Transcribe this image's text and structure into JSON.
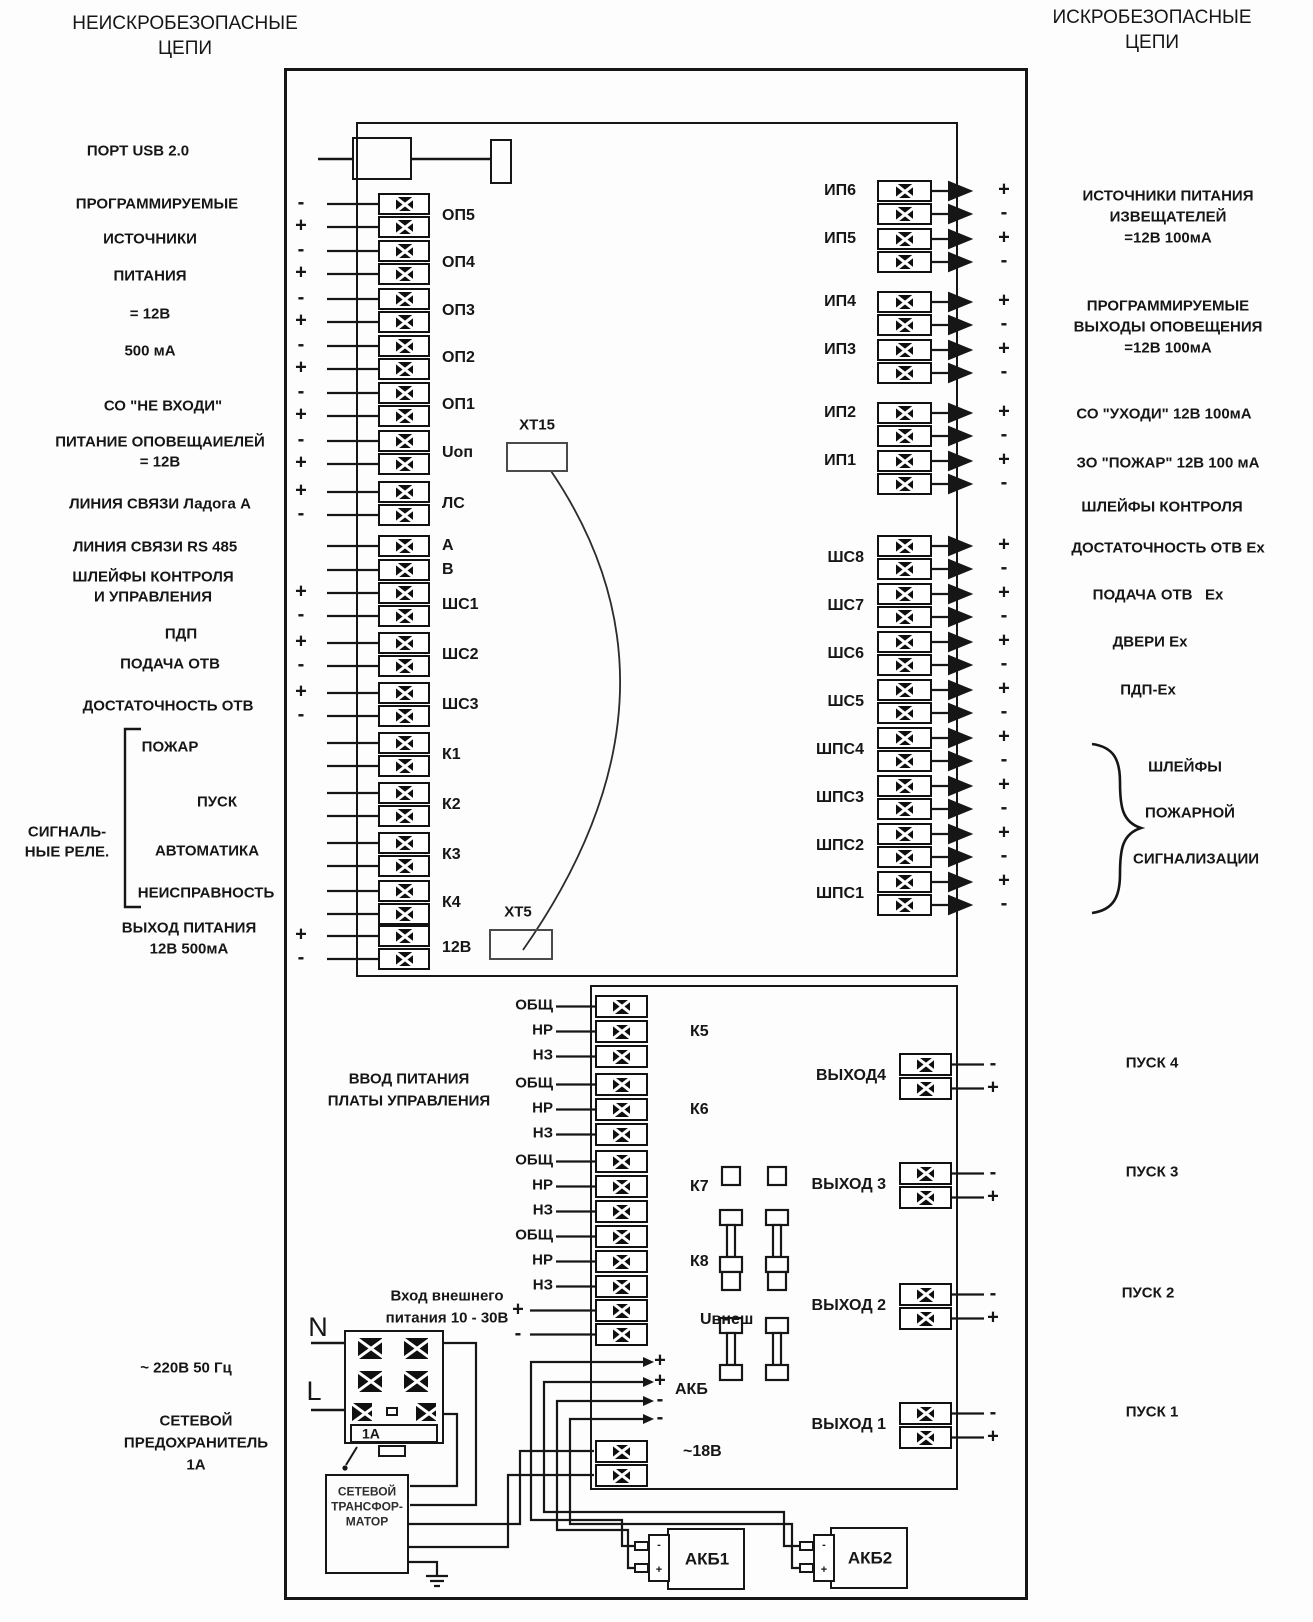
{
  "titles": {
    "left_line1": "НЕИСКРОБЕЗОПАСНЫЕ",
    "left_line2": "ЦЕПИ",
    "right_line1": "ИСКРОБЕЗОПАСНЫЕ",
    "right_line2": "ЦЕПИ"
  },
  "left_annotations": [
    {
      "text": "ПОРТ USB 2.0"
    },
    {
      "text": "ПРОГРАММИРУЕМЫЕ"
    },
    {
      "text": "ИСТОЧНИКИ"
    },
    {
      "text": "ПИТАНИЯ"
    },
    {
      "text": "= 12В"
    },
    {
      "text": "500 мА"
    },
    {
      "text": "СО \"НЕ ВХОДИ\""
    },
    {
      "text": "ПИТАНИЕ ОПОВЕЩАИЕЛЕЙ"
    },
    {
      "text": "= 12В"
    },
    {
      "text": "ЛИНИЯ СВЯЗИ Ладога А"
    },
    {
      "text": "ЛИНИЯ СВЯЗИ RS 485"
    },
    {
      "text": "ШЛЕЙФЫ КОНТРОЛЯ"
    },
    {
      "text": "И УПРАВЛЕНИЯ"
    },
    {
      "text": "ПДП"
    },
    {
      "text": "ПОДАЧА ОТВ"
    },
    {
      "text": "ДОСТАТОЧНОСТЬ ОТВ"
    },
    {
      "text": "ПОЖАР"
    },
    {
      "text": "ПУСК"
    },
    {
      "text": "АВТОМАТИКА"
    },
    {
      "text": "НЕИСПРАВНОСТЬ"
    },
    {
      "text": "СИГНАЛЬ-"
    },
    {
      "text": "НЫЕ РЕЛЕ."
    },
    {
      "text": "ВЫХОД ПИТАНИЯ"
    },
    {
      "text": "12В 500мА"
    },
    {
      "text": "~ 220В 50 Гц"
    },
    {
      "text": "СЕТЕВОЙ"
    },
    {
      "text": "ПРЕДОХРАНИТЕЛЬ"
    },
    {
      "text": "1А"
    }
  ],
  "right_annotations": [
    {
      "text": "ИСТОЧНИКИ ПИТАНИЯ"
    },
    {
      "text": "ИЗВЕЩАТЕЛЕЙ"
    },
    {
      "text": "=12В 100мА"
    },
    {
      "text": "ПРОГРАММИРУЕМЫЕ"
    },
    {
      "text": "ВЫХОДЫ ОПОВЕЩЕНИЯ"
    },
    {
      "text": "=12В 100мА"
    },
    {
      "text": "СО \"УХОДИ\" 12В 100мА"
    },
    {
      "text": "ЗО \"ПОЖАР\" 12В 100 мА"
    },
    {
      "text": "ШЛЕЙФЫ КОНТРОЛЯ"
    },
    {
      "text": "ДОСТАТОЧНОСТЬ ОТВ Ex"
    },
    {
      "text": "ПОДАЧА ОТВ   Ex"
    },
    {
      "text": "ДВЕРИ Ex"
    },
    {
      "text": "ПДП-Ex"
    },
    {
      "text": "ШЛЕЙФЫ"
    },
    {
      "text": "ПОЖАРНОЙ"
    },
    {
      "text": "СИГНАЛИЗАЦИИ"
    },
    {
      "text": "ПУСК 4"
    },
    {
      "text": "ПУСК 3"
    },
    {
      "text": "ПУСК 2"
    },
    {
      "text": "ПУСК 1"
    }
  ],
  "board1": {
    "left_groups": [
      {
        "id": "op5",
        "label": "ОП5",
        "signs": [
          "-",
          "+"
        ]
      },
      {
        "id": "op4",
        "label": "ОП4",
        "signs": [
          "-",
          "+"
        ]
      },
      {
        "id": "op3",
        "label": "ОП3",
        "signs": [
          "-",
          "+"
        ]
      },
      {
        "id": "op2",
        "label": "ОП2",
        "signs": [
          "-",
          "+"
        ]
      },
      {
        "id": "op1",
        "label": "ОП1",
        "signs": [
          "-",
          "+"
        ]
      },
      {
        "id": "uop",
        "label": "Uоп",
        "signs": [
          "-",
          "+"
        ]
      },
      {
        "id": "ls",
        "label": "ЛС",
        "signs": [
          "+",
          "-"
        ]
      },
      {
        "id": "a",
        "label": "А",
        "signs": [
          ""
        ]
      },
      {
        "id": "b",
        "label": "В",
        "signs": [
          ""
        ]
      },
      {
        "id": "shs1",
        "label": "ШС1",
        "signs": [
          "+",
          "-"
        ]
      },
      {
        "id": "shs2",
        "label": "ШС2",
        "signs": [
          "+",
          "-"
        ]
      },
      {
        "id": "shs3",
        "label": "ШС3",
        "signs": [
          "+",
          "-"
        ]
      },
      {
        "id": "k1",
        "label": "К1",
        "signs": [
          "",
          ""
        ]
      },
      {
        "id": "k2",
        "label": "К2",
        "signs": [
          "",
          ""
        ]
      },
      {
        "id": "k3",
        "label": "К3",
        "signs": [
          "",
          ""
        ]
      },
      {
        "id": "k4",
        "label": "К4",
        "signs": [
          "",
          ""
        ]
      },
      {
        "id": "12v",
        "label": "12В",
        "signs": [
          "+",
          "-"
        ]
      }
    ],
    "ip_groups": [
      {
        "id": "ip6",
        "label": "ИП6",
        "signs": [
          "+",
          "-"
        ]
      },
      {
        "id": "ip5",
        "label": "ИП5",
        "signs": [
          "+",
          "-"
        ]
      },
      {
        "id": "ip4",
        "label": "ИП4",
        "signs": [
          "+",
          "-"
        ]
      },
      {
        "id": "ip3",
        "label": "ИП3",
        "signs": [
          "+",
          "-"
        ]
      },
      {
        "id": "ip2",
        "label": "ИП2",
        "signs": [
          "+",
          "-"
        ]
      },
      {
        "id": "ip1",
        "label": "ИП1",
        "signs": [
          "+",
          "-"
        ]
      }
    ],
    "shs_groups": [
      {
        "id": "shs8",
        "label": "ШС8",
        "signs": [
          "+",
          "-"
        ]
      },
      {
        "id": "shs7",
        "label": "ШС7",
        "signs": [
          "+",
          "-"
        ]
      },
      {
        "id": "shs6",
        "label": "ШС6",
        "signs": [
          "+",
          "-"
        ]
      },
      {
        "id": "shs5",
        "label": "ШС5",
        "signs": [
          "+",
          "-"
        ]
      },
      {
        "id": "shps4",
        "label": "ШПС4",
        "signs": [
          "+",
          "-"
        ]
      },
      {
        "id": "shps3",
        "label": "ШПС3",
        "signs": [
          "+",
          "-"
        ]
      },
      {
        "id": "shps2",
        "label": "ШПС2",
        "signs": [
          "+",
          "-"
        ]
      },
      {
        "id": "shps1",
        "label": "ШПС1",
        "signs": [
          "+",
          "-"
        ]
      }
    ]
  },
  "board2": {
    "relays": [
      {
        "id": "k5",
        "label": "К5",
        "pins": [
          "ОБЩ",
          "НР",
          "НЗ"
        ]
      },
      {
        "id": "k6",
        "label": "К6",
        "pins": [
          "ОБЩ",
          "НР",
          "НЗ"
        ]
      },
      {
        "id": "k7",
        "label": "К7",
        "pins": [
          "ОБЩ",
          "НР",
          "НЗ"
        ]
      },
      {
        "id": "k8",
        "label": "К8",
        "pins": [
          "ОБЩ",
          "НР",
          "НЗ"
        ]
      }
    ],
    "uvnesh": {
      "label": "Uвнеш",
      "signs": [
        "+",
        "-"
      ]
    },
    "v18": {
      "label": "~18В"
    },
    "akb": {
      "label": "АКБ",
      "signs": [
        "+",
        "+",
        "-",
        "-"
      ]
    },
    "outputs": [
      {
        "id": "out4",
        "label": "ВЫХОД4",
        "signs": [
          "-",
          "+"
        ]
      },
      {
        "id": "out3",
        "label": "ВЫХОД 3",
        "signs": [
          "-",
          "+"
        ]
      },
      {
        "id": "out2",
        "label": "ВЫХОД 2",
        "signs": [
          "-",
          "+"
        ]
      },
      {
        "id": "out1",
        "label": "ВЫХОД 1",
        "signs": [
          "-",
          "+"
        ]
      }
    ]
  },
  "power": {
    "n": "N",
    "l": "L",
    "ext_line1": "Вход внешнего",
    "ext_line2": "питания 10 - 30В",
    "vvod_line1": "ВВОД ПИТАНИЯ",
    "vvod_line2": "ПЛАТЫ УПРАВЛЕНИЯ",
    "fuse_value": "1А",
    "transformer_line1": "СЕТЕВОЙ",
    "transformer_line2": "ТРАНСФОР-",
    "transformer_line3": "МАТОР",
    "akb1": "АКБ1",
    "akb2": "АКБ2",
    "plug_minus": "-",
    "plug_plus": "+"
  },
  "connectors": {
    "xt15": "ХТ15",
    "xt5": "ХТ5"
  },
  "colors": {
    "ink": "#161616",
    "background": "#fdfdfd"
  }
}
